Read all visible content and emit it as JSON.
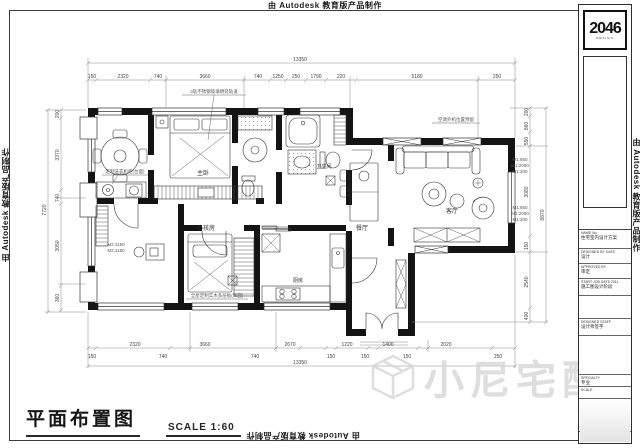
{
  "edge_marks": {
    "top": "由 Autodesk 教育版产品制作",
    "left": "由 Autodesk 教育版产品制作",
    "right": "由 Autodesk 教育版产品制作",
    "bottom": "由 Autodesk 教育版产品制作"
  },
  "title": {
    "text": "平面布置图",
    "scale_label": "SCALE 1:60"
  },
  "watermark": {
    "brand": "小尼宅配"
  },
  "title_block": {
    "logo": "2046",
    "logo_sub": "DESIGN",
    "f1_label": "NAME No.",
    "f1_value": "住宅室内设计方案",
    "f2_label": "DESIGNED BY DATE",
    "f2_value": "设计",
    "f3_label": "APPROVED BY",
    "f3_value": "审定",
    "f4_label": "START JOB DATE 2011",
    "f4_value": "施工图设计阶段",
    "f5_label": "DESIGNED STAFF",
    "f5_value": "设计师签字",
    "f6_label": "SPECIALTY",
    "f6_value": "专业",
    "f7_label": "SCALE",
    "f7_value": "",
    "f8_label": "DRAWN BLOCK",
    "f8_value": "图名",
    "f9_value": "平面布置图",
    "f10_label": "DRAWING NUMBER",
    "f10_value": "图号"
  },
  "rooms": {
    "master_bedroom": "主卧",
    "kids_room": "小孩房",
    "living_room": "客厅",
    "dining_area": "餐厅",
    "bathroom": "卫生间",
    "kitchen": "厨房"
  },
  "annotations": {
    "partition_note": "3轨不锈钢玻璃明装轨道",
    "ac_note": "空调外机位置预留",
    "closet_note": "全屋定制实木多层板(饰面)",
    "laundry_note": "定制洗衣机柜(台面)",
    "door_mark_a1": "M1:650",
    "door_mark_a2": "M1:2000",
    "door_mark_a3": "M1:200",
    "door_mark_b1": "M1:650",
    "door_mark_b2": "M1:2000",
    "door_mark_b3": "M1:200",
    "door_mark_c1": "M2:1150",
    "door_mark_c2": "M2:1190"
  },
  "dims": {
    "top": {
      "overall": "13350",
      "values": [
        "150",
        "2320",
        "740",
        "3660",
        "740",
        "1250",
        "250",
        "1790",
        "220",
        "5180",
        "250"
      ]
    },
    "bottom": {
      "overall": "13350",
      "row1": [
        "2320",
        "3660",
        "2670",
        "1220",
        "1400",
        "2020"
      ],
      "row2": [
        "150",
        "740",
        "740",
        "150",
        "150",
        "150",
        "250"
      ]
    },
    "left": {
      "overall": "7720",
      "values": [
        "200",
        "3370",
        "740",
        "3050",
        "360"
      ]
    },
    "right": {
      "overall": "8870",
      "values": [
        "200",
        "860",
        "550",
        "3080",
        "150",
        "2540",
        "400"
      ]
    }
  }
}
